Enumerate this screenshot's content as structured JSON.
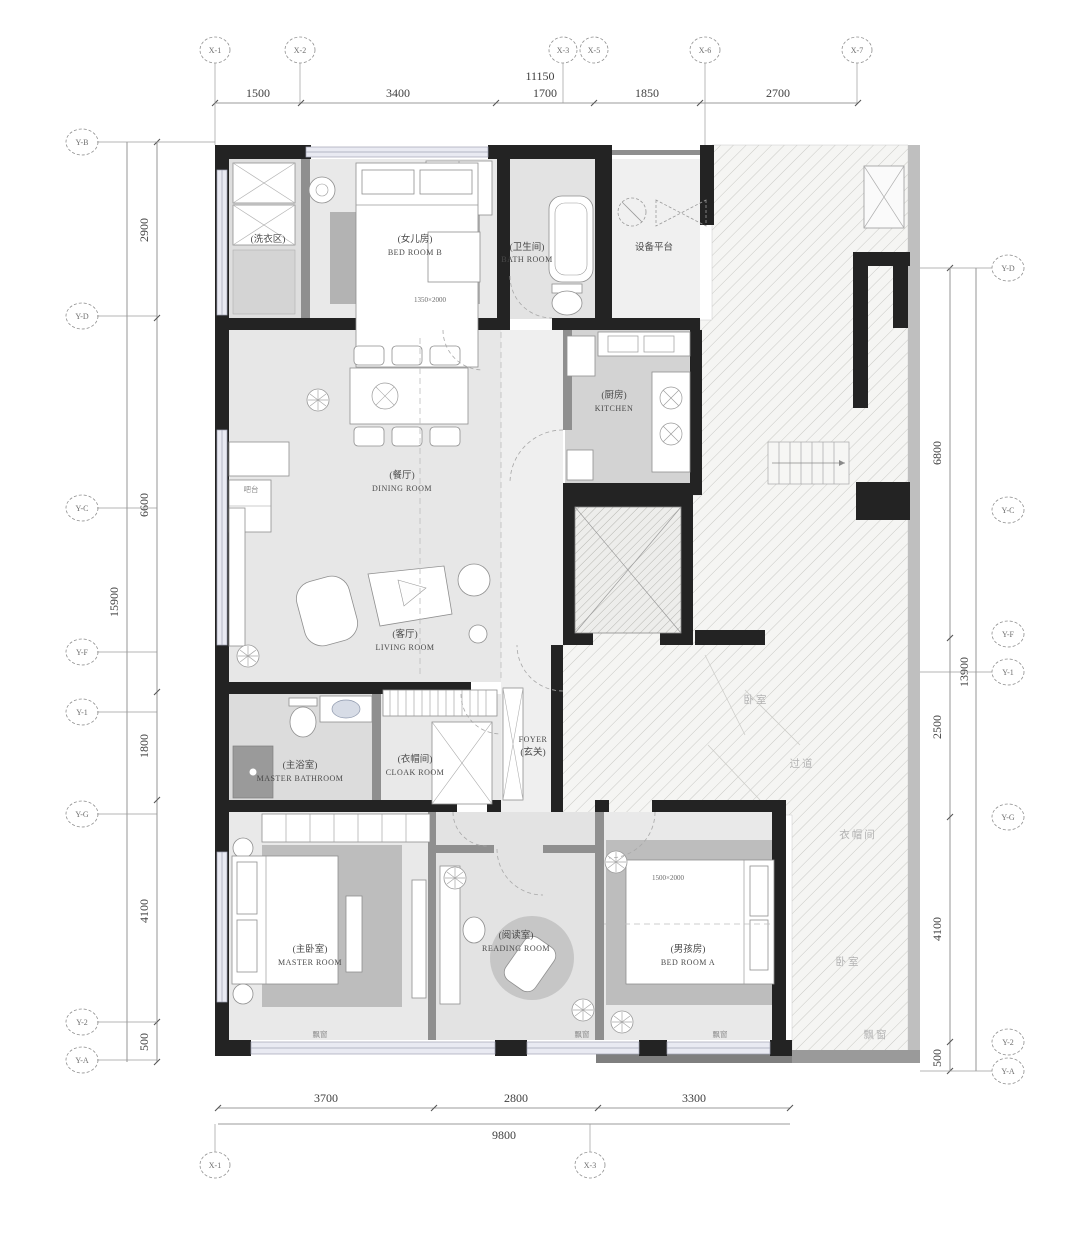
{
  "dims": {
    "top": {
      "total": "11150",
      "segs": [
        "1500",
        "3400",
        "1700",
        "1850",
        "2700"
      ]
    },
    "left": {
      "total": "15900",
      "segs": [
        "2900",
        "6600",
        "1800",
        "4100",
        "500"
      ]
    },
    "right": {
      "total": "13900",
      "segs": [
        "6800",
        "2500",
        "4100",
        "500"
      ]
    },
    "bottom": {
      "total": "9800",
      "segs": [
        "3700",
        "2800",
        "3300"
      ]
    }
  },
  "axes": {
    "top": [
      "X-1",
      "X-2",
      "X-3",
      "X-5",
      "X-6",
      "X-7"
    ],
    "bottom": [
      "X-1",
      "X-3"
    ],
    "left": [
      "Y-B",
      "Y-D",
      "Y-C",
      "Y-F",
      "Y-1",
      "Y-G",
      "Y-2",
      "Y-A"
    ],
    "right": [
      "Y-D",
      "Y-C",
      "Y-F",
      "Y-1",
      "Y-G",
      "Y-2",
      "Y-A"
    ]
  },
  "rooms": {
    "bedroomB": {
      "zh": "(女儿房)",
      "en": "BED ROOM B",
      "size": "1350×2000"
    },
    "laundry": {
      "zh": "(洗衣区)"
    },
    "bath": {
      "zh": "(卫生间)",
      "en": "BATH ROOM"
    },
    "equipment": {
      "zh": "设备平台"
    },
    "kitchen": {
      "zh": "(厨房)",
      "en": "KITCHEN"
    },
    "dining": {
      "zh": "(餐厅)",
      "en": "DINING ROOM"
    },
    "bar": {
      "zh": "吧台"
    },
    "living": {
      "zh": "(客厅)",
      "en": "LIVING ROOM"
    },
    "foyer": {
      "en": "FOYER",
      "zh": "(玄关)"
    },
    "masterBath": {
      "zh": "(主浴室)",
      "en": "MASTER BATHROOM"
    },
    "cloak": {
      "zh": "(衣帽间)",
      "en": "CLOAK ROOM"
    },
    "master": {
      "zh": "(主卧室)",
      "en": "MASTER ROOM"
    },
    "reading": {
      "zh": "(阅读室)",
      "en": "READING ROOM"
    },
    "bedroomA": {
      "zh": "(男孩房)",
      "en": "BED ROOM A",
      "size": "1500×2000"
    }
  },
  "misc": {
    "bay": "飘窗"
  },
  "neighbor_labels": [
    "衣帽间",
    "卧室",
    "飘窗",
    "过道",
    "卧室"
  ]
}
